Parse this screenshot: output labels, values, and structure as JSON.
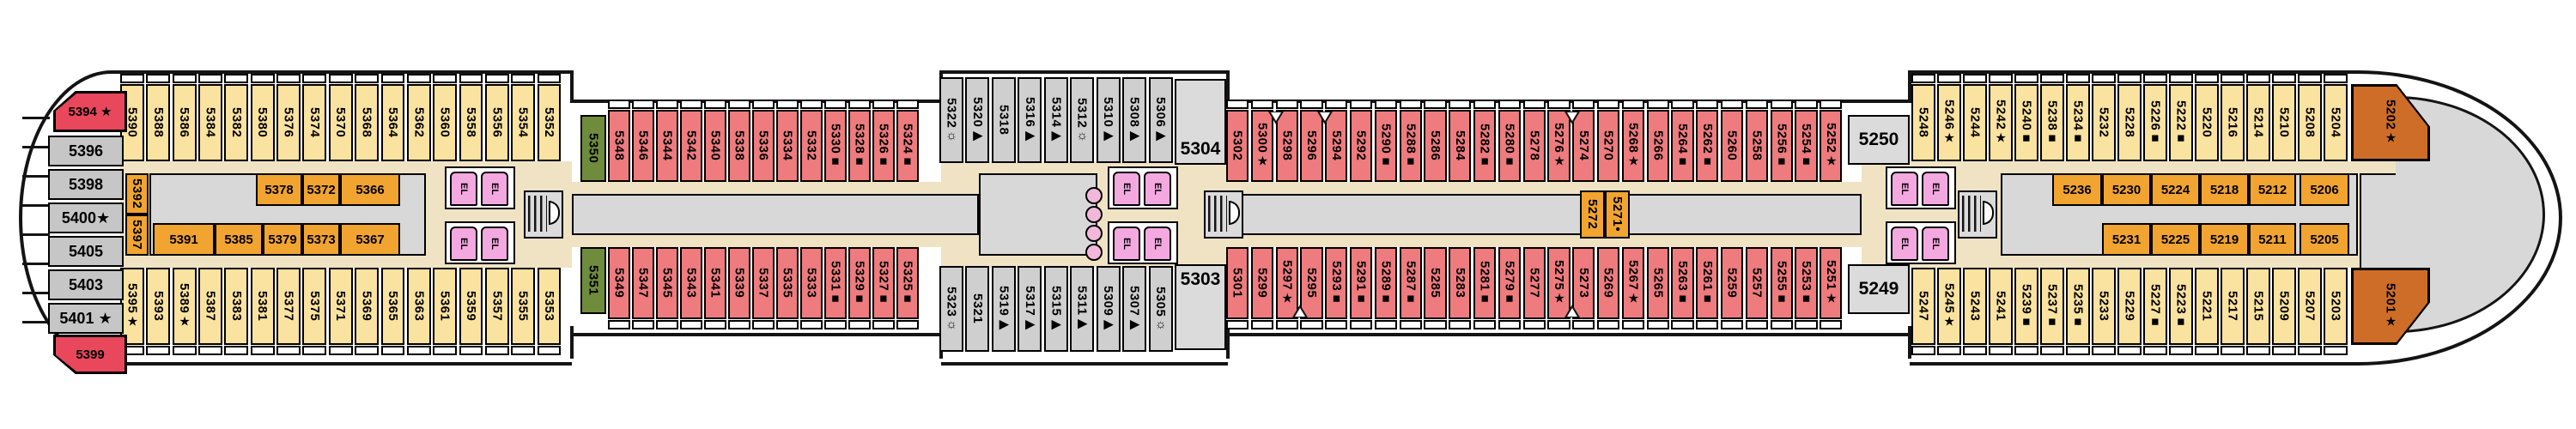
{
  "colors": {
    "balcony_yellow": "#FAE2A0",
    "balcony_red": "#EE7B7E",
    "aft_crimson": "#E8475C",
    "oceanview_gray": "#CFCFCF",
    "aft_view_green": "#6F8C3D",
    "interior_orange": "#F2A430",
    "bow_suite_orange": "#CE6D28",
    "corridor_tan": "#F0E3C4",
    "room_gray": "#DBDBDB",
    "elevator_pink": "#F4A8E0",
    "hull_black": "#141414"
  },
  "stern": {
    "suite_top": "5394 ★",
    "stack": [
      "5396",
      "5398",
      "5400★",
      "5405",
      "5403",
      "5401 ★"
    ],
    "suite_bottom": "5399"
  },
  "rows": {
    "top_a": [
      "5390",
      "5388",
      "5386",
      "5384",
      "5382",
      "5380",
      "5376",
      "5374",
      "5370",
      "5368",
      "5364",
      "5362",
      "5360",
      "5358",
      "5356",
      "5354",
      "5352"
    ],
    "top_b_green": "5350",
    "top_b_red": [
      "5348",
      "5346",
      "5344",
      "5342",
      "5340",
      "5338",
      "5336",
      "5334",
      "5332",
      "5330■",
      "5328■",
      "5326■",
      "5324■"
    ],
    "top_c_gray": [
      "5322☼",
      "5320▶",
      "5318",
      "5316▶",
      "5314▶",
      "5312☼",
      "5310▶",
      "5308▶",
      "5306▶"
    ],
    "top_d_red": [
      "5302",
      "5300★",
      "5298",
      "5296",
      "5294",
      "5292",
      "5290■",
      "5288■",
      "5286",
      "5284",
      "5282■",
      "5280■",
      "5278",
      "5276★",
      "5274",
      "5270",
      "5268★",
      "5266",
      "5264■",
      "5262■",
      "5260",
      "5258",
      "5256■",
      "5254■",
      "5252★"
    ],
    "top_e_yellow": [
      "5248",
      "5246★",
      "5244",
      "5242★",
      "5240■",
      "5238■",
      "5234■",
      "5232",
      "5228",
      "5226■",
      "5222■",
      "5220",
      "5216",
      "5214",
      "5210",
      "5208",
      "5204"
    ],
    "bow_suite_top": "5202★",
    "bottom_a": [
      "5395★",
      "5393",
      "5389★",
      "5387",
      "5383",
      "5381",
      "5377",
      "5375",
      "5371",
      "5369",
      "5365",
      "5363",
      "5361",
      "5359",
      "5357",
      "5355",
      "5353"
    ],
    "bottom_b_green": "5351",
    "bottom_b_red": [
      "5349",
      "5347",
      "5345",
      "5343",
      "5341",
      "5339",
      "5337",
      "5335",
      "5333",
      "5331■",
      "5329■",
      "5327■",
      "5325■"
    ],
    "bottom_c_gray": [
      "5323☼",
      "5321",
      "5319▶",
      "5317▶",
      "5315▶",
      "5311▶",
      "5309▶",
      "5307▶",
      "5305☼"
    ],
    "bottom_d_red": [
      "5301",
      "5299",
      "5297★",
      "5295",
      "5293■",
      "5291■",
      "5289■",
      "5287■",
      "5285",
      "5283",
      "5281■",
      "5279■",
      "5277",
      "5275★",
      "5273",
      "5269",
      "5267★",
      "5265",
      "5263■",
      "5261■",
      "5259",
      "5257",
      "5255■",
      "5253■",
      "5251★"
    ],
    "bottom_e_yellow": [
      "5247",
      "5245★",
      "5243",
      "5241",
      "5239■",
      "5237■",
      "5235■",
      "5233",
      "5229",
      "5227■",
      "5223■",
      "5221",
      "5217",
      "5215",
      "5209",
      "5207",
      "5203"
    ],
    "bow_suite_bottom": "5201★"
  },
  "interior": {
    "aft_vertical": [
      "5392",
      "5397"
    ],
    "aft_top": [
      "5378",
      "5372",
      "5366"
    ],
    "aft_bottom": [
      "5391",
      "5385",
      "5379",
      "5373",
      "5367"
    ],
    "mid_vertical": [
      "5272",
      "5271•"
    ],
    "fwd_top": [
      "5236",
      "5230",
      "5224",
      "5218",
      "5212",
      "5206"
    ],
    "fwd_bottom": [
      "5231",
      "5225",
      "5219",
      "5211",
      "5205"
    ]
  },
  "rooms": {
    "r5304": "5304",
    "r5303": "5303",
    "r5250": "5250",
    "r5249": "5249"
  },
  "elevator_label": "EL"
}
